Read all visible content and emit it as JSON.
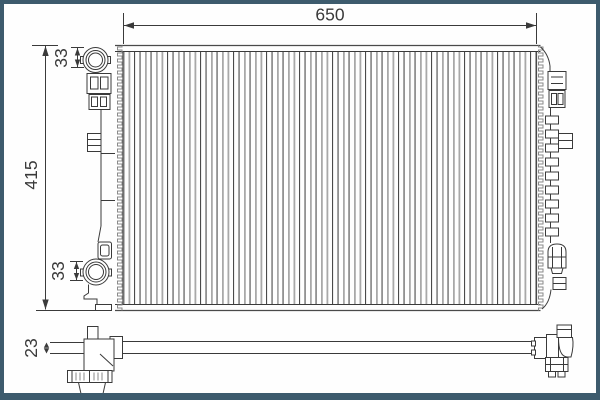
{
  "page": {
    "background": "#fefefe",
    "frame_color": "#3d5b6d"
  },
  "diagram": {
    "subject": "radiator-two-view-technical-drawing",
    "views": [
      "front-view",
      "bottom-side-view"
    ],
    "line_color": "#3a3a3a",
    "tube_light_color": "#a8a8a8",
    "tube_dark_color": "#4a4a4a",
    "dimensions": {
      "overall_width": "650",
      "overall_height": "415",
      "top_port_offset": "33",
      "bottom_port_offset": "33",
      "core_depth": "23"
    }
  }
}
